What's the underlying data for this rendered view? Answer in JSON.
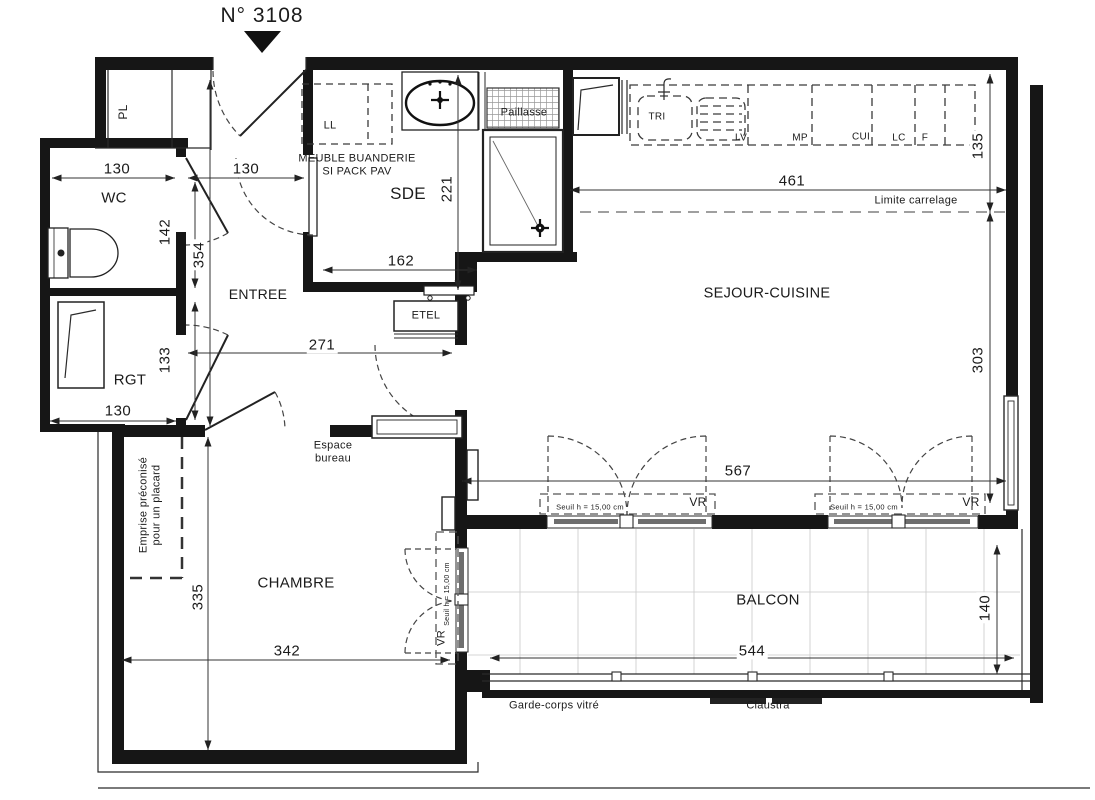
{
  "title": "N° 3108",
  "rooms": {
    "pl": "PL",
    "wc": "WC",
    "entree": "ENTREE",
    "sde": "SDE",
    "rgt": "RGT",
    "sejour_cuisine": "SEJOUR-CUISINE",
    "chambre": "CHAMBRE",
    "balcon": "BALCON"
  },
  "annotations": {
    "ll": "LL",
    "meuble_buanderie": "MEUBLE BUANDERIE SI PACK PAV",
    "paillasse": "Paillasse",
    "etel": "ETEL",
    "tri": "TRI",
    "lv": "LV",
    "mp": "MP",
    "cui": "CUI",
    "lc": "LC",
    "f": "F",
    "limite_carrelage": "Limite carrelage",
    "espace_bureau": "Espace bureau",
    "emprise_placard": "Emprise préconisé pour un placard",
    "vr": "VR",
    "seuil": "Seuil h = 15,00 cm",
    "garde_corps": "Garde-corps vitré",
    "claustra": "Claustra"
  },
  "dimensions_cm": {
    "wc_width": "130",
    "entree_door": "130",
    "wc_depth": "142",
    "entree_length": "354",
    "rgt_depth": "133",
    "rgt_width": "130",
    "entree_width": "271",
    "sde_width": "162",
    "sde_depth": "221",
    "cuisine_width": "461",
    "cuisine_depth": "135",
    "sejour_depth": "303",
    "sejour_width": "567",
    "balcon_width": "544",
    "balcon_depth": "140",
    "chambre_depth": "335",
    "chambre_width": "342"
  },
  "colors": {
    "wall": "#161616",
    "line": "#2a2a2a",
    "dash": "#555555",
    "glazing": "#6e6e6e",
    "tile_grid": "#c9c9c9",
    "background": "#ffffff"
  }
}
